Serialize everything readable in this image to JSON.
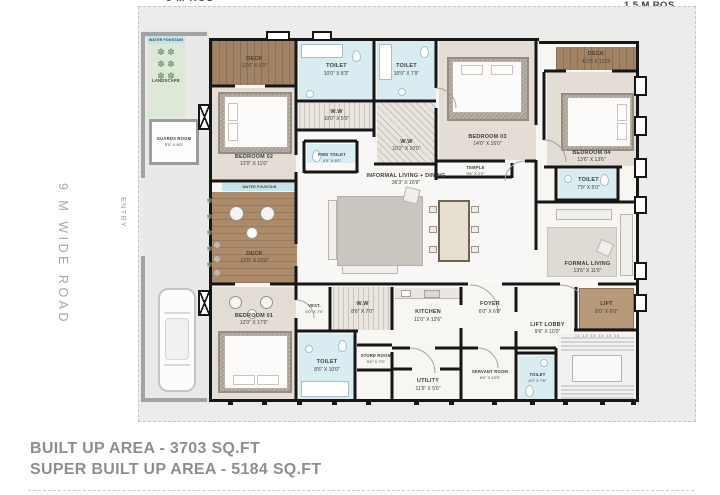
{
  "annotations": {
    "top_setback": "5 M ROS",
    "right_setback": "1.5 M ROS",
    "road": "9 M WIDE ROAD",
    "entry": "ENTRY",
    "stair_numbers": "11 12 13 14 15 16"
  },
  "footer": {
    "line1": "BUILT UP AREA - 3703 SQ.FT",
    "line2": "SUPER BUILT UP AREA - 5184 SQ.FT"
  },
  "rooms": [
    {
      "name": "DECK",
      "dims": "12'0\" X 5'0\""
    },
    {
      "name": "TOILET",
      "dims": "10'0\" X 8'3\""
    },
    {
      "name": "W.W",
      "dims": "10'0\" X 5'0\""
    },
    {
      "name": "BEDROOM 02",
      "dims": "12'0\" X 11'0\""
    },
    {
      "name": "PWD TOILET",
      "dims": "5'0\" X 6'0\""
    },
    {
      "name": "TOILET",
      "dims": "10'9\" X 7'9\""
    },
    {
      "name": "W.W",
      "dims": "10'2\" X 10'0\""
    },
    {
      "name": "BEDROOM 03",
      "dims": "14'0\" X 16'0\""
    },
    {
      "name": "TEMPLE",
      "dims": "9'6\" X 2'0\""
    },
    {
      "name": "DECK",
      "dims": "4175 X 1225"
    },
    {
      "name": "BEDROOM 04",
      "dims": "13'6\" X 13'6\""
    },
    {
      "name": "TOILET",
      "dims": "7'9\" X 5'0\""
    },
    {
      "name": "INFORMAL LIVING + DINING",
      "dims": "36'3\" X 16'9\""
    },
    {
      "name": "FORMAL LIVING",
      "dims": "13'6\" X 11'6\""
    },
    {
      "name": "WATER FOUNTAIN",
      "dims": ""
    },
    {
      "name": "DECK",
      "dims": "12'0\" X 10'0\""
    },
    {
      "name": "BEDROOM 01",
      "dims": "12'0\" X 17'6\""
    },
    {
      "name": "VEST.",
      "dims": "5'0\" X 7'0\""
    },
    {
      "name": "W.W",
      "dims": "8'6\" X 7'0\""
    },
    {
      "name": "TOILET",
      "dims": "8'6\" X 10'0\""
    },
    {
      "name": "STORE ROOM",
      "dims": "5'0\" X 7'0\""
    },
    {
      "name": "UTILITY",
      "dims": "11'6\" X 5'6\""
    },
    {
      "name": "KITCHEN",
      "dims": "11'0\" X 12'6\""
    },
    {
      "name": "FOYER",
      "dims": "6'0\" X 6'0\""
    },
    {
      "name": "SERVANT ROOM",
      "dims": "6'0\" X 13'3\""
    },
    {
      "name": "TOILET",
      "dims": "4'0\" X 7'6\""
    },
    {
      "name": "LIFT LOBBY",
      "dims": "9'6\" X 10'0\""
    },
    {
      "name": "LIFT",
      "dims": "8'0\" X 6'0\""
    },
    {
      "name": "LANDSCAPE",
      "dims": ""
    },
    {
      "name": "GUARDS ROOM",
      "dims": "5'0\" X 5'0\""
    },
    {
      "name": "WATER FOUNTAIN",
      "dims": ""
    }
  ],
  "icons": {
    "plant_grid": "✽  ✽\n✽  ✽\n✽  ✽",
    "plant_column": "✽\n✽\n✽\n✽\n✽"
  },
  "colors": {
    "wall": "#161616",
    "deck_wood": "#a28365",
    "toilet_blue": "#d8ecf2",
    "bedroom_carpet": "#e3ddd5",
    "rug": "#a79f95",
    "lift_tan": "#b79878",
    "landscape_green": "#dde8d8",
    "water_blue": "#c2e4ed",
    "site_gray": "#ecedeb",
    "footer_text": "#8e8e8c"
  }
}
